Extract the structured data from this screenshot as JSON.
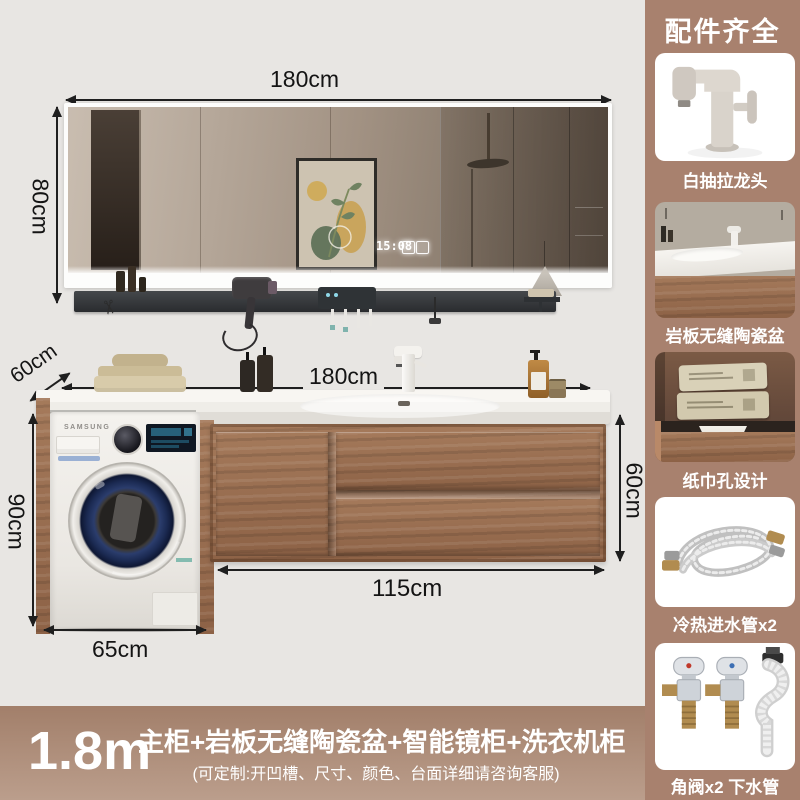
{
  "product": {
    "annotations": {
      "mirror_width": "180cm",
      "mirror_height": "80cm",
      "counter_depth": "60cm",
      "counter_width": "180cm",
      "washer_column_height": "90cm",
      "washer_width": "65cm",
      "cabinet_width": "115cm",
      "cabinet_side_height": "60cm"
    },
    "mirror_clock": "15:08",
    "washer_brand": "SAMSUNG"
  },
  "sidebar": {
    "title": "配件齐全",
    "items": [
      {
        "name": "pull-out-faucet",
        "label": "白抽拉龙头"
      },
      {
        "name": "slate-seamless-ceramic-basin",
        "label": "岩板无缝陶瓷盆"
      },
      {
        "name": "tissue-hole-design",
        "label": "纸巾孔设计"
      },
      {
        "name": "hot-cold-inlet-hoses",
        "label": "冷热进水管x2"
      },
      {
        "name": "angle-valves-drain-pipe",
        "label": "角阀x2 下水管"
      }
    ]
  },
  "footer": {
    "size": "1.8m",
    "title": "主柜+岩板无缝陶瓷盆+智能镜柜+洗衣机柜",
    "subtitle": "(可定制:开凹槽、尺寸、颜色、台面详细请咨询客服)"
  },
  "colors": {
    "canvas_bg": "#e8e6e3",
    "sidebar_bg": "#a8816e",
    "footer_top": "#a27f6a",
    "footer_bottom": "#bb9e8c",
    "wood": "#9a6e50",
    "dimension_line": "#1f1f1f",
    "washer_door_navy": "#1b2a52"
  }
}
